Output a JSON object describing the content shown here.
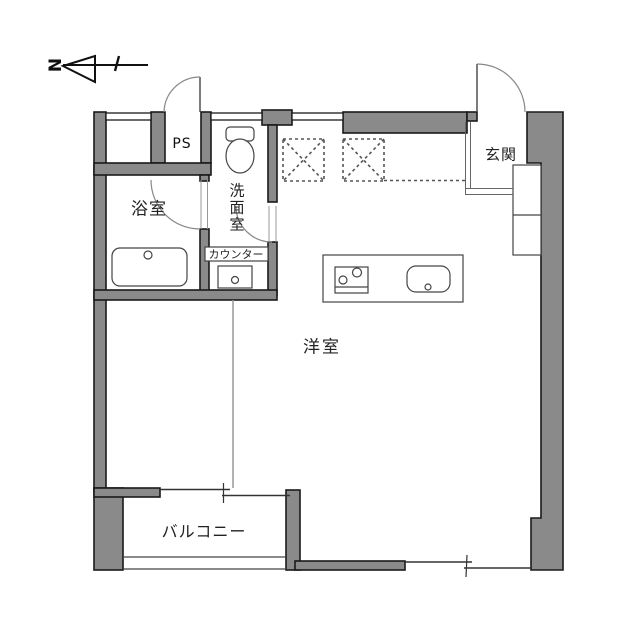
{
  "compass": {
    "label": "N"
  },
  "rooms": {
    "ps": "PS",
    "bathroom": "浴室",
    "washroom": "洗面室",
    "counter": "カウンター",
    "entrance": "玄関",
    "main_room": "洋室",
    "balcony": "バルコニー"
  },
  "fixtures": {
    "toilet": "toilet",
    "bathtub": "bathtub",
    "counter_sink": "counter-sink",
    "kitchen_island": "kitchen-island",
    "stove": "stove",
    "kitchen_sink": "kitchen-sink",
    "shoe_cabinet": "shoe-cabinet",
    "overhead_storage": "overhead-storage-dashed",
    "balcony_railing": "balcony-railing"
  },
  "colors": {
    "wall_fill": "#8a8a8a",
    "wall_outline": "#1a1a1a",
    "thin_line": "#555555",
    "door_arc": "#888888",
    "background": "#ffffff",
    "text": "#222222"
  }
}
